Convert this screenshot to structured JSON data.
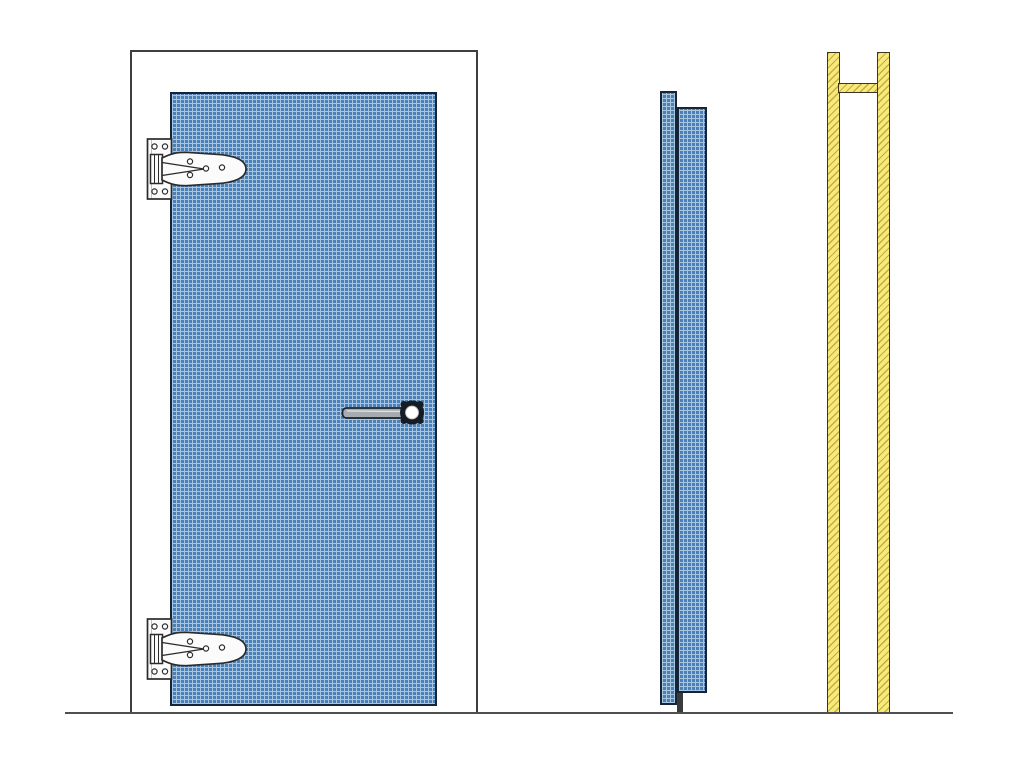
{
  "diagram": {
    "kind": "door-technical-drawing",
    "views": {
      "front_elevation": {
        "components": [
          "door-frame",
          "door-leaf",
          "strap-hinge-top",
          "strap-hinge-bottom",
          "lever-handle"
        ]
      },
      "edge_profile": {
        "components": [
          "leaf-overlay-panel",
          "leaf-core-panel",
          "bottom-seal-bar"
        ]
      },
      "jamb_section": {
        "components": [
          "left-jamb",
          "right-jamb",
          "head-rail"
        ]
      },
      "ground": [
        "floor-line"
      ]
    },
    "colors": {
      "background": "#ffffff",
      "door_fill": "#4a7fb7",
      "door_grid_light": "#a8c6e0",
      "door_grid_dark": "#2e567f",
      "door_border": "#16243a",
      "frame_fill": "#ffffff",
      "frame_border": "#3f3f3f",
      "hinge_fill": "#fbfbfb",
      "hinge_outline": "#2b2b2b",
      "handle_bar": "#a7abaf",
      "handle_outline": "#1d232b",
      "handle_rosette": "#141c26",
      "jamb_fill": "#f8e97c",
      "jamb_hatch": "#c4ad3e",
      "jamb_border": "#3d3520",
      "seal_bar": "#3a3a3a",
      "ground_line": "#4f4f4f"
    }
  }
}
